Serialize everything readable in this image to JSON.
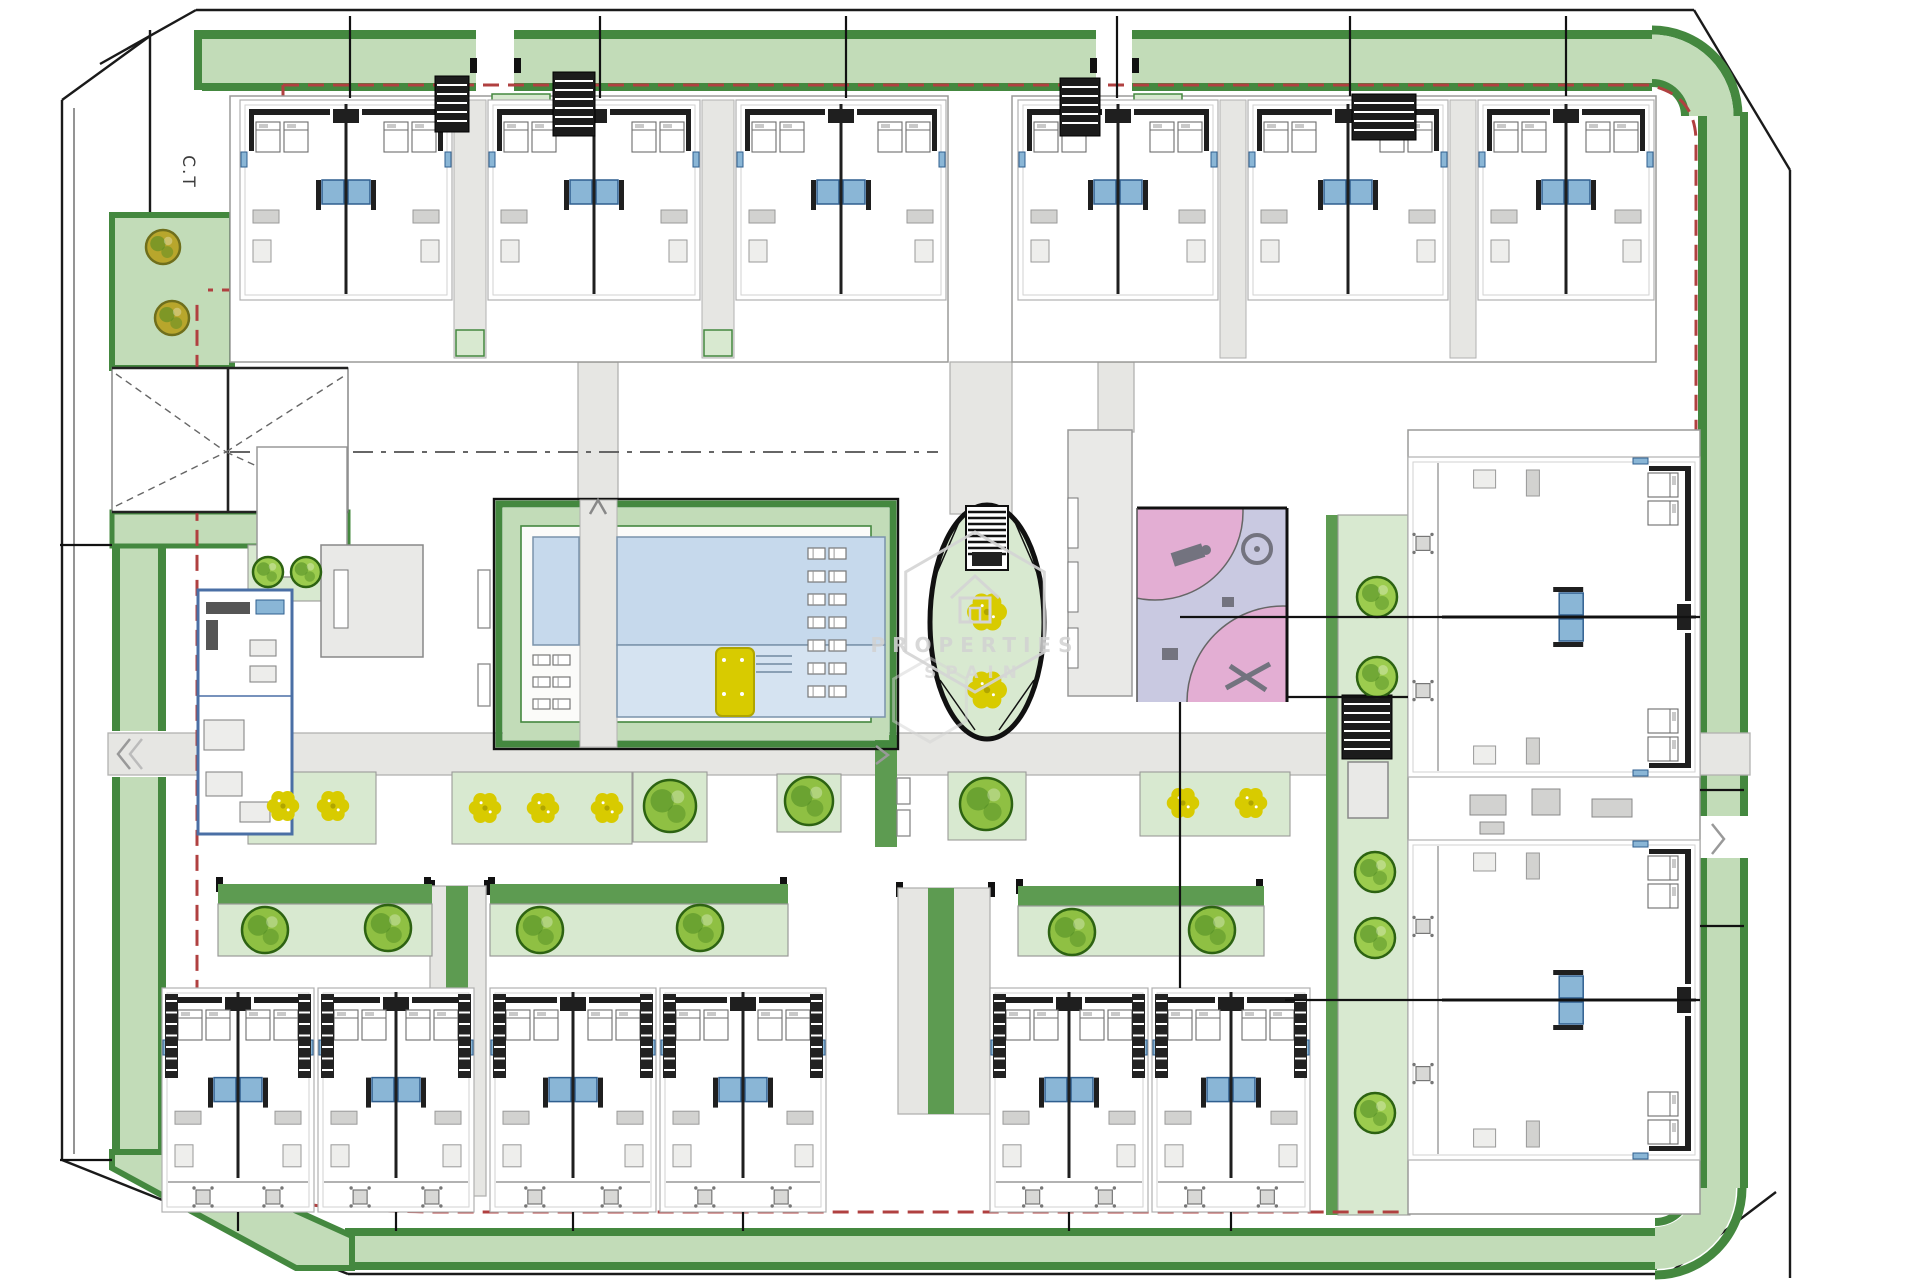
{
  "meta": {
    "plan_name": "residential-site-plan",
    "width": 1920,
    "height": 1280
  },
  "labels": {
    "plot": "C.T",
    "watermark_top": "PROPERTIES",
    "watermark_bottom": "SPAIN"
  },
  "colors": {
    "boundary": "#1a1a1a",
    "band_dark": "#44883f",
    "band_light": "#c2dcb8",
    "strip_green": "#5d9b51",
    "pad_green": "#d8e9d0",
    "tree_fill": "#8fc043",
    "tree_dark": "#4e8a22",
    "tree_edge": "#2d6312",
    "olive_fill": "#b8a62c",
    "olive_edge": "#6f6f1c",
    "bush_fill": "#9ccc4e",
    "flower": "#d8cb00",
    "flower_edge": "#b0a500",
    "pool_water": "#c6d9ec",
    "pool_water2": "#d5e3f1",
    "pool_edge": "#7a93ab",
    "walk_gray": "#e6e6e3",
    "walk_edge": "#b2b2b0",
    "bldg_gray": "#e9e9e7",
    "bldg_edge": "#8a8a88",
    "blue_border": "#4a6fa5",
    "bath_blue": "#8ab6d6",
    "bath_dark": "#2f5f8f",
    "play_pink": "#e3aed3",
    "play_lav": "#c9c9e1",
    "play_equip": "#73737f",
    "red_dash": "#b04040",
    "wall": "#1f1f1f",
    "furn": "#a8a8a8",
    "furn_light": "#d2d2d0",
    "watermark": "#d4d4d4"
  },
  "boundary_lines": [
    [
      100,
      64,
      196,
      10
    ],
    [
      196,
      10,
      1694,
      10
    ],
    [
      1694,
      10,
      1790,
      170
    ],
    [
      1790,
      170,
      1790,
      1278
    ],
    [
      62,
      100,
      150,
      36
    ],
    [
      62,
      100,
      62,
      1160
    ],
    [
      150,
      30,
      150,
      368
    ],
    [
      62,
      1160,
      348,
      1274
    ],
    [
      348,
      1274,
      1668,
      1274
    ],
    [
      1668,
      1274,
      1776,
      1192
    ]
  ],
  "boundary_thin": [
    [
      74,
      108,
      74,
      1154
    ]
  ],
  "band": {
    "segments": [
      {
        "x": 194,
        "y": 30,
        "w": 8,
        "h": 60,
        "c": "band_dark"
      },
      {
        "x": 202,
        "y": 30,
        "w": 1450,
        "h": 9,
        "c": "band_dark"
      },
      {
        "x": 202,
        "y": 39,
        "w": 1450,
        "h": 44,
        "c": "band_light"
      },
      {
        "x": 202,
        "y": 83,
        "w": 1450,
        "h": 8,
        "c": "band_dark"
      },
      {
        "x": 1698,
        "y": 112,
        "w": 9,
        "h": 1076,
        "c": "band_dark"
      },
      {
        "x": 1707,
        "y": 112,
        "w": 33,
        "h": 1076,
        "c": "band_light"
      },
      {
        "x": 1740,
        "y": 112,
        "w": 8,
        "h": 1076,
        "c": "band_dark"
      },
      {
        "x": 345,
        "y": 1228,
        "w": 1312,
        "h": 8,
        "c": "band_dark"
      },
      {
        "x": 345,
        "y": 1236,
        "w": 1312,
        "h": 26,
        "c": "band_light"
      },
      {
        "x": 345,
        "y": 1262,
        "w": 1312,
        "h": 8,
        "c": "band_dark"
      },
      {
        "x": 112,
        "y": 546,
        "w": 8,
        "h": 616,
        "c": "band_dark"
      },
      {
        "x": 120,
        "y": 546,
        "w": 38,
        "h": 616,
        "c": "band_light"
      },
      {
        "x": 158,
        "y": 546,
        "w": 8,
        "h": 616,
        "c": "band_dark"
      }
    ],
    "outlined": [
      {
        "x": 112,
        "y": 215,
        "w": 120,
        "h": 153,
        "c": "band_light",
        "s": "band_dark",
        "sw": 6
      },
      {
        "x": 112,
        "y": 512,
        "w": 236,
        "h": 34,
        "c": "band_light",
        "s": "band_dark",
        "sw": 5
      }
    ],
    "corner_arcs": [
      {
        "d": "M1652,30 A86,86 0 0 1 1738,116",
        "c": "band_dark",
        "w": 9
      },
      {
        "d": "M1652,57 A59,59 0 0 1 1711,116",
        "c": "band_light",
        "w": 45
      },
      {
        "d": "M1652,83 A33,33 0 0 1 1685,116",
        "c": "band_dark",
        "w": 8
      },
      {
        "d": "M1742,1188 A87,87 0 0 1 1655,1275",
        "c": "band_dark",
        "w": 9
      },
      {
        "d": "M1715,1188 A60,60 0 0 1 1655,1248",
        "c": "band_light",
        "w": 42
      },
      {
        "d": "M1689,1188 A34,34 0 0 1 1655,1222",
        "c": "band_dark",
        "w": 8
      }
    ],
    "corner_poly": {
      "points": "112,1152 166,1152 352,1236 352,1268 296,1268 112,1168",
      "c": "band_light",
      "s": "band_dark",
      "sw": 6
    },
    "gaps": [
      {
        "x": 476,
        "y": 27,
        "w": 38,
        "h": 66
      },
      {
        "x": 1096,
        "y": 27,
        "w": 36,
        "h": 66
      },
      {
        "x": 104,
        "y": 731,
        "w": 66,
        "h": 46
      },
      {
        "x": 1692,
        "y": 816,
        "w": 58,
        "h": 42
      }
    ],
    "posts": [
      [
        470,
        58
      ],
      [
        514,
        58
      ],
      [
        1090,
        58
      ],
      [
        1132,
        58
      ],
      [
        428,
        880
      ],
      [
        484,
        880
      ],
      [
        896,
        882
      ],
      [
        988,
        882
      ],
      [
        216,
        877
      ],
      [
        424,
        877
      ],
      [
        488,
        877
      ],
      [
        780,
        877
      ],
      [
        1016,
        879
      ],
      [
        1256,
        879
      ]
    ]
  },
  "red_boundary": {
    "paths": [
      "M283,85 H1648 Q1696,94 1696,142 V1178 Q1696,1212 1652,1212 H446 Q206,1212 197,1148 V300",
      "M283,85 V290 H208"
    ],
    "dash": "16 9",
    "w": 3
  },
  "entrance": {
    "box": {
      "x": 112,
      "y": 368,
      "w": 236,
      "h": 144
    },
    "heavy": [
      [
        112,
        368,
        348,
        368
      ],
      [
        112,
        512,
        348,
        512
      ],
      [
        228,
        368,
        228,
        512
      ]
    ],
    "xdash": [
      [
        116,
        374,
        226,
        452
      ],
      [
        116,
        506,
        226,
        452
      ],
      [
        226,
        452,
        344,
        376
      ],
      [
        226,
        452,
        344,
        506
      ]
    ],
    "centerline": {
      "d": "M230,452 H938",
      "dash": "20 8 5 8"
    }
  },
  "walkways": [
    {
      "x": 108,
      "y": 733,
      "w": 1642,
      "h": 42
    },
    {
      "x": 950,
      "y": 362,
      "w": 62,
      "h": 152
    },
    {
      "x": 578,
      "y": 362,
      "w": 40,
      "h": 140
    },
    {
      "x": 1098,
      "y": 362,
      "w": 36,
      "h": 70
    },
    {
      "x": 430,
      "y": 886,
      "w": 56,
      "h": 310
    },
    {
      "x": 898,
      "y": 888,
      "w": 92,
      "h": 226
    }
  ],
  "green_strips": [
    {
      "x": 446,
      "y": 886,
      "w": 22,
      "h": 310
    },
    {
      "x": 928,
      "y": 888,
      "w": 26,
      "h": 226
    },
    {
      "x": 875,
      "y": 735,
      "w": 22,
      "h": 112
    },
    {
      "x": 1326,
      "y": 515,
      "w": 12,
      "h": 700
    }
  ],
  "pad_rects": [
    {
      "x": 1338,
      "y": 515,
      "w": 72,
      "h": 700
    },
    {
      "x": 248,
      "y": 772,
      "w": 128,
      "h": 72
    },
    {
      "x": 452,
      "y": 772,
      "w": 180,
      "h": 72
    },
    {
      "x": 633,
      "y": 772,
      "w": 74,
      "h": 70
    },
    {
      "x": 777,
      "y": 774,
      "w": 64,
      "h": 58
    },
    {
      "x": 948,
      "y": 772,
      "w": 78,
      "h": 68
    },
    {
      "x": 1140,
      "y": 772,
      "w": 150,
      "h": 64
    },
    {
      "x": 248,
      "y": 545,
      "w": 74,
      "h": 56
    }
  ],
  "terraces": {
    "strips": [
      {
        "x": 232,
        "y": 300,
        "w": 716,
        "h": 46
      },
      {
        "x": 1014,
        "y": 300,
        "w": 642,
        "h": 46
      }
    ],
    "caps": [
      {
        "x": 232,
        "y": 346,
        "w": 716,
        "h": 16
      },
      {
        "x": 1014,
        "y": 346,
        "w": 642,
        "h": 16
      }
    ],
    "patios": [
      [
        266,
        54
      ],
      [
        372,
        54
      ],
      [
        514,
        54
      ],
      [
        620,
        54
      ],
      [
        761,
        54
      ],
      [
        867,
        54
      ],
      [
        1042,
        52
      ],
      [
        1142,
        52
      ],
      [
        1272,
        52
      ],
      [
        1372,
        52
      ],
      [
        1496,
        52
      ],
      [
        1584,
        52
      ]
    ],
    "patio_y": 300,
    "patio_h": 46,
    "table_y": 331
  },
  "top_blocks": [
    {
      "x": 230,
      "y": 96,
      "w": 718,
      "h": 266,
      "seps": [
        [
          454,
          32
        ],
        [
          702,
          32
        ]
      ]
    },
    {
      "x": 1012,
      "y": 96,
      "w": 644,
      "h": 266,
      "seps": [
        [
          1220,
          26
        ],
        [
          1450,
          26
        ]
      ]
    }
  ],
  "duplexes_top": [
    [
      240,
      100,
      212,
      200
    ],
    [
      488,
      100,
      212,
      200
    ],
    [
      736,
      100,
      210,
      200
    ],
    [
      1018,
      100,
      200,
      200
    ],
    [
      1248,
      100,
      200,
      200
    ],
    [
      1478,
      100,
      176,
      200
    ]
  ],
  "duplexes_bottom": [
    [
      162,
      988,
      152,
      224
    ],
    [
      318,
      988,
      156,
      224
    ],
    [
      490,
      988,
      166,
      224
    ],
    [
      660,
      988,
      166,
      224
    ],
    [
      990,
      988,
      158,
      224
    ],
    [
      1152,
      988,
      158,
      224
    ]
  ],
  "right_block": {
    "frame": {
      "x": 1408,
      "y": 430,
      "w": 292,
      "h": 784
    },
    "duplexes": [
      {
        "cx": 1554,
        "cy": 617,
        "w": 320,
        "h": 292
      },
      {
        "cx": 1554,
        "cy": 1000,
        "w": 320,
        "h": 292
      }
    ],
    "core_furniture": [
      [
        1470,
        795,
        36,
        20
      ],
      [
        1532,
        789,
        28,
        26
      ],
      [
        1592,
        799,
        40,
        18
      ],
      [
        1480,
        822,
        24,
        12
      ]
    ]
  },
  "planters": [
    {
      "cap": [
        218,
        884,
        214,
        20
      ],
      "pad": [
        218,
        904,
        214,
        52
      ]
    },
    {
      "cap": [
        490,
        884,
        298,
        20
      ],
      "pad": [
        490,
        904,
        298,
        52
      ]
    },
    {
      "cap": [
        1018,
        886,
        246,
        20
      ],
      "pad": [
        1018,
        906,
        246,
        50
      ]
    }
  ],
  "pool": {
    "outline": {
      "x": 494,
      "y": 499,
      "w": 404,
      "h": 250
    },
    "border": {
      "x": 499,
      "y": 504,
      "w": 394,
      "h": 240
    },
    "light": {
      "x": 503,
      "y": 508,
      "w": 386,
      "h": 232
    },
    "deck": {
      "x": 521,
      "y": 526,
      "w": 350,
      "h": 196
    },
    "walk": {
      "x": 580,
      "y": 500,
      "w": 37,
      "h": 247
    },
    "water": [
      {
        "x": 617,
        "y": 537,
        "w": 268,
        "h": 108,
        "c": "pool_water"
      },
      {
        "x": 617,
        "y": 645,
        "w": 268,
        "h": 72,
        "c": "pool_water2"
      },
      {
        "x": 533,
        "y": 537,
        "w": 46,
        "h": 108,
        "c": "pool_water"
      }
    ],
    "parasol": {
      "x": 716,
      "y": 648,
      "w": 38,
      "h": 68
    },
    "steps": [
      [
        756,
        656,
        792,
        656
      ],
      [
        756,
        664,
        792,
        664
      ],
      [
        756,
        672,
        792,
        672
      ]
    ]
  },
  "oval": {
    "cx": 987,
    "cy": 622,
    "rx": 57,
    "ry": 117,
    "stair": {
      "x": 966,
      "y": 506,
      "w": 42,
      "h": 64
    },
    "landing": {
      "x": 972,
      "y": 552,
      "w": 30,
      "h": 14
    },
    "rails": [
      [
        936,
        575,
        963,
        513
      ],
      [
        1038,
        575,
        1011,
        513
      ],
      [
        940,
        680,
        975,
        730
      ],
      [
        1034,
        680,
        999,
        730
      ]
    ]
  },
  "playground": {
    "x": 1137,
    "y": 508,
    "w": 150,
    "h": 194,
    "circles": [
      {
        "cx": 1155,
        "cy": 512,
        "r": 88
      },
      {
        "cx": 1283,
        "cy": 702,
        "r": 96
      }
    ],
    "benches": [
      [
        1222,
        597,
        12,
        10
      ],
      [
        1162,
        648,
        16,
        12
      ]
    ],
    "carousel": {
      "cx": 1257,
      "cy": 549,
      "r": 14
    },
    "rider": {
      "x": 1172,
      "y": 548,
      "w": 32,
      "h": 14,
      "rot": -18
    },
    "seesaw": {
      "cx": 1248,
      "cy": 676
    }
  },
  "buildings": [
    {
      "x": 257,
      "y": 447,
      "w": 90,
      "h": 130,
      "fill": "#ffffff",
      "s": "#999999",
      "name": "facility-building"
    },
    {
      "x": 321,
      "y": 545,
      "w": 102,
      "h": 112,
      "fill": "bldg_gray",
      "s": "#888888",
      "name": "facility-building"
    },
    {
      "x": 1068,
      "y": 430,
      "w": 64,
      "h": 266,
      "fill": "bldg_gray",
      "s": "#999999",
      "name": "pergola-building"
    },
    {
      "x": 1348,
      "y": 762,
      "w": 40,
      "h": 56,
      "fill": "bldg_gray",
      "s": "#888888",
      "name": "core-annex"
    }
  ],
  "building_slots": [
    [
      334,
      570,
      14,
      58
    ],
    [
      1068,
      498,
      10,
      50
    ],
    [
      1068,
      562,
      10,
      50
    ],
    [
      1068,
      628,
      10,
      40
    ]
  ],
  "blue_room": {
    "x": 198,
    "y": 590,
    "w": 94,
    "h": 244,
    "divider_y": 696,
    "dark_furn": [
      [
        206,
        602,
        44,
        12
      ],
      [
        206,
        620,
        12,
        30
      ]
    ],
    "gray_furn": [
      [
        250,
        640,
        26,
        16
      ],
      [
        250,
        666,
        26,
        16
      ],
      [
        204,
        720,
        40,
        30
      ],
      [
        206,
        772,
        36,
        24
      ],
      [
        240,
        802,
        30,
        20
      ]
    ],
    "blue_accent": [
      256,
      600,
      28,
      14
    ]
  },
  "stair_blocks": [
    [
      435,
      76,
      34,
      56
    ],
    [
      553,
      72,
      42,
      64
    ],
    [
      1060,
      78,
      40,
      58
    ],
    [
      1352,
      94,
      64,
      46
    ],
    [
      1342,
      695,
      50,
      64
    ]
  ],
  "green_patches_top": [
    [
      492,
      94,
      58,
      40
    ],
    [
      1134,
      94,
      48,
      40
    ],
    [
      456,
      330,
      28,
      26
    ],
    [
      704,
      330,
      28,
      26
    ]
  ],
  "greens": {
    "trees": [
      [
        265,
        930,
        23
      ],
      [
        388,
        928,
        23
      ],
      [
        540,
        930,
        23
      ],
      [
        700,
        928,
        23
      ],
      [
        1072,
        932,
        23
      ],
      [
        1212,
        930,
        23
      ],
      [
        670,
        806,
        26
      ],
      [
        809,
        801,
        24
      ],
      [
        986,
        804,
        26
      ]
    ],
    "olives": [
      [
        163,
        247,
        17
      ],
      [
        172,
        318,
        17
      ]
    ],
    "bushes": [
      [
        268,
        572,
        15
      ],
      [
        306,
        572,
        15
      ],
      [
        1377,
        597,
        20
      ],
      [
        1377,
        677,
        20
      ],
      [
        1375,
        872,
        20
      ],
      [
        1375,
        938,
        20
      ],
      [
        1375,
        1113,
        20
      ]
    ],
    "flowers": [
      [
        283,
        806,
        1.3
      ],
      [
        333,
        806,
        1.3
      ],
      [
        485,
        808,
        1.3
      ],
      [
        543,
        808,
        1.3
      ],
      [
        607,
        808,
        1.3
      ],
      [
        1183,
        803,
        1.3
      ],
      [
        1251,
        803,
        1.3
      ],
      [
        987,
        612,
        1.6
      ],
      [
        987,
        690,
        1.6
      ]
    ]
  },
  "lounger_columns": [
    {
      "x": 808,
      "y": 548,
      "rows": 7,
      "sp": 23,
      "w": 17,
      "h": 11,
      "gap": 4
    },
    {
      "x": 533,
      "y": 655,
      "rows": 3,
      "sp": 22,
      "w": 17,
      "h": 10,
      "gap": 3
    }
  ],
  "benches": [
    [
      478,
      570,
      12,
      58
    ],
    [
      478,
      664,
      12,
      42
    ],
    [
      897,
      778,
      13,
      26
    ],
    [
      897,
      810,
      13,
      26
    ]
  ],
  "division_lines": [
    [
      350,
      16,
      350,
      98
    ],
    [
      600,
      16,
      600,
      98
    ],
    [
      846,
      16,
      846,
      98
    ],
    [
      1117,
      16,
      1117,
      98
    ],
    [
      1350,
      16,
      1350,
      96
    ],
    [
      1566,
      16,
      1566,
      96
    ],
    [
      60,
      545,
      112,
      545
    ],
    [
      60,
      1160,
      112,
      1160
    ],
    [
      1700,
      790,
      1744,
      790
    ],
    [
      1700,
      926,
      1744,
      926
    ],
    [
      1180,
      702,
      1180,
      988
    ],
    [
      1287,
      697,
      1408,
      697
    ],
    [
      1180,
      617,
      1700,
      617
    ],
    [
      1285,
      1000,
      1700,
      1000
    ],
    [
      238,
      1212,
      238,
      1231
    ],
    [
      396,
      1212,
      396,
      1231
    ],
    [
      573,
      1212,
      573,
      1231
    ],
    [
      743,
      1212,
      743,
      1231
    ],
    [
      1069,
      1212,
      1069,
      1231
    ],
    [
      1231,
      1212,
      1231,
      1231
    ]
  ],
  "arrows": [
    {
      "pts": "130,739 118,754 130,769",
      "c": "#999999"
    },
    {
      "pts": "142,739 130,754 142,769",
      "c": "#bbbbbb"
    },
    {
      "pts": "1712,824 1724,839 1712,854",
      "c": "#999999"
    },
    {
      "pts": "590,514 598,500 606,514",
      "c": "#888888"
    },
    {
      "pts": "876,746 888,755 876,764",
      "c": "#999999"
    }
  ],
  "watermark": {
    "hexes": [
      {
        "cx": 975,
        "cy": 612,
        "r": 80,
        "o": 0.9
      },
      {
        "cx": 930,
        "cy": 700,
        "r": 42,
        "o": 0.5
      }
    ],
    "house": {
      "cx": 975,
      "cy": 596
    }
  }
}
